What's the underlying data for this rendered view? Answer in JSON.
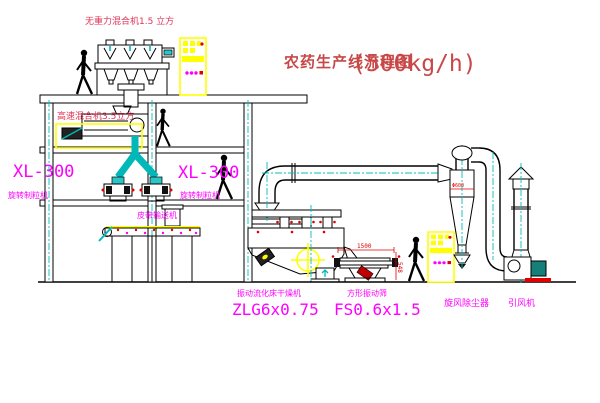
{
  "title": {
    "text": "农药生产线流程图",
    "capacity": "(500kg/h)"
  },
  "equipment_labels": {
    "top_mixer": "无重力混合机1.5 立方",
    "second_mixer": "高速混合机3.5立方",
    "granulator_left": {
      "model": "XL-300",
      "name": "旋转制粒机"
    },
    "granulator_mid": {
      "model": "XL-300",
      "name": "旋转制粒机"
    },
    "belt_conveyor": "皮带输送机",
    "dryer": {
      "name": "振动流化床干燥机",
      "model": "ZLG6x0.75"
    },
    "sieve": {
      "name": "方形振动筛",
      "model": "FS0.6x1.5"
    },
    "cyclone": "旋风除尘器",
    "fan": "引风机"
  },
  "dimensions": {
    "sieve_length": "1500",
    "sieve_height": "548",
    "cyclone_dim": "Φ600"
  },
  "colors": {
    "label_magenta": "#ff00ff",
    "label_red": "#e03355",
    "title_red": "#c84848",
    "line_cyan": "#00c0c0",
    "accent_yellow": "#ffff00",
    "dot_red": "#e00000"
  }
}
